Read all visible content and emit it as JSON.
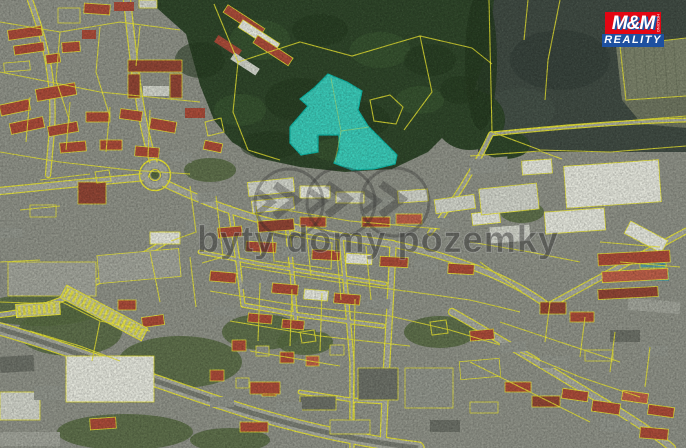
{
  "watermark": {
    "text": "byty domy pozemky"
  },
  "logo": {
    "title": "M&M",
    "subtitle": "REALITY",
    "side_text": "HOLDING"
  },
  "colors": {
    "base": "#8d9086",
    "forest": "#2e4529",
    "forest_dark": "#24381f",
    "forest_light": "#3d5a33",
    "field": "#3f4a42",
    "field_light": "#7a8169",
    "green": "#55683f",
    "road": "#a5a89d",
    "road_dark": "#6b6f66",
    "cadastral": "#e8e431",
    "highlight": "#3bd7c6",
    "highlight_border": "#0fb4a4",
    "roof_red": "#a84a38",
    "roof_red_light": "#bb5e48",
    "roof_dark_red": "#8f4434",
    "bldg_white": "#e2e4da",
    "bldg_light": "#cfd2c8",
    "bldg_gray": "#8f938a",
    "bldg_dark": "#6b6f66",
    "paving": "#a0a399",
    "hatch": "#c6c78a",
    "teal_roof": "#58989e",
    "logo_red": "#e30613",
    "logo_blue": "#1e50a0"
  }
}
